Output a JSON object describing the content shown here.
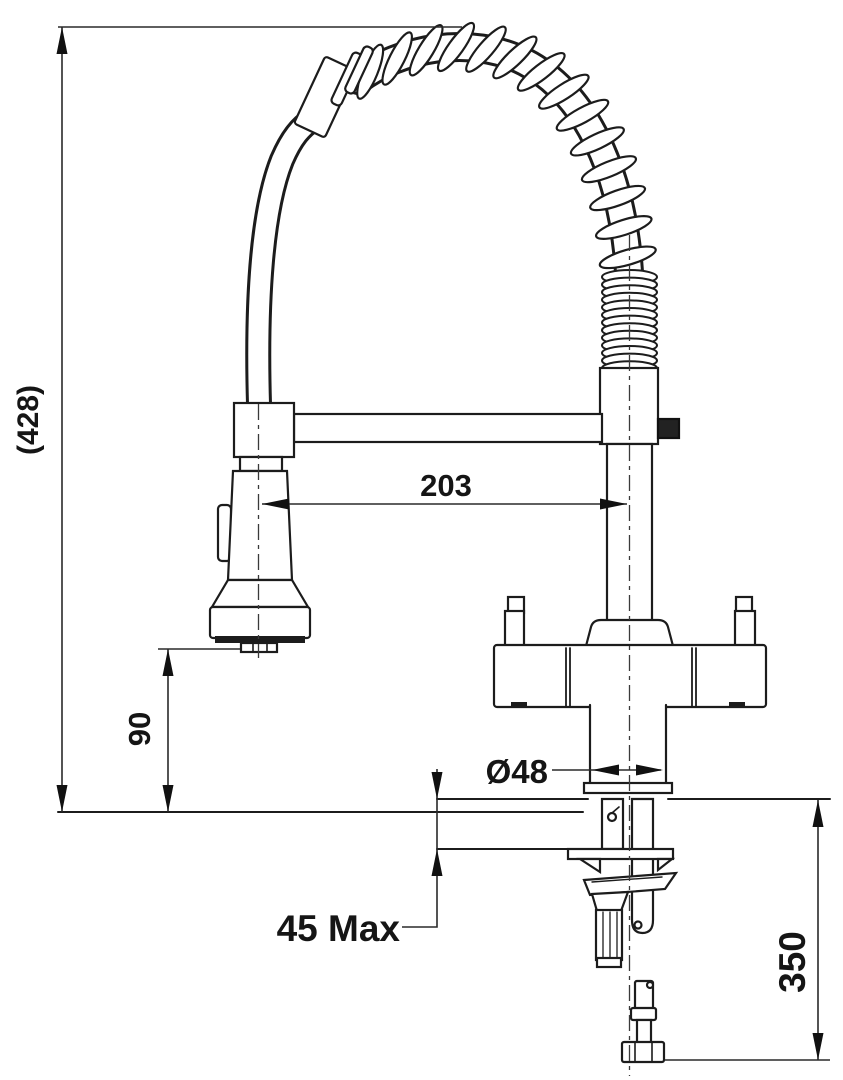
{
  "diagram": {
    "kind": "faucet-installation-dimension-drawing",
    "dimensions": {
      "overall_height": "(428)",
      "spout_reach": "203",
      "head_to_deck": "90",
      "base_diameter": "Ø48",
      "max_deck_thickness": "45 Max",
      "supply_hose_length": "350"
    },
    "colors": {
      "line": "#1f1f1f",
      "background": "#ffffff"
    }
  }
}
